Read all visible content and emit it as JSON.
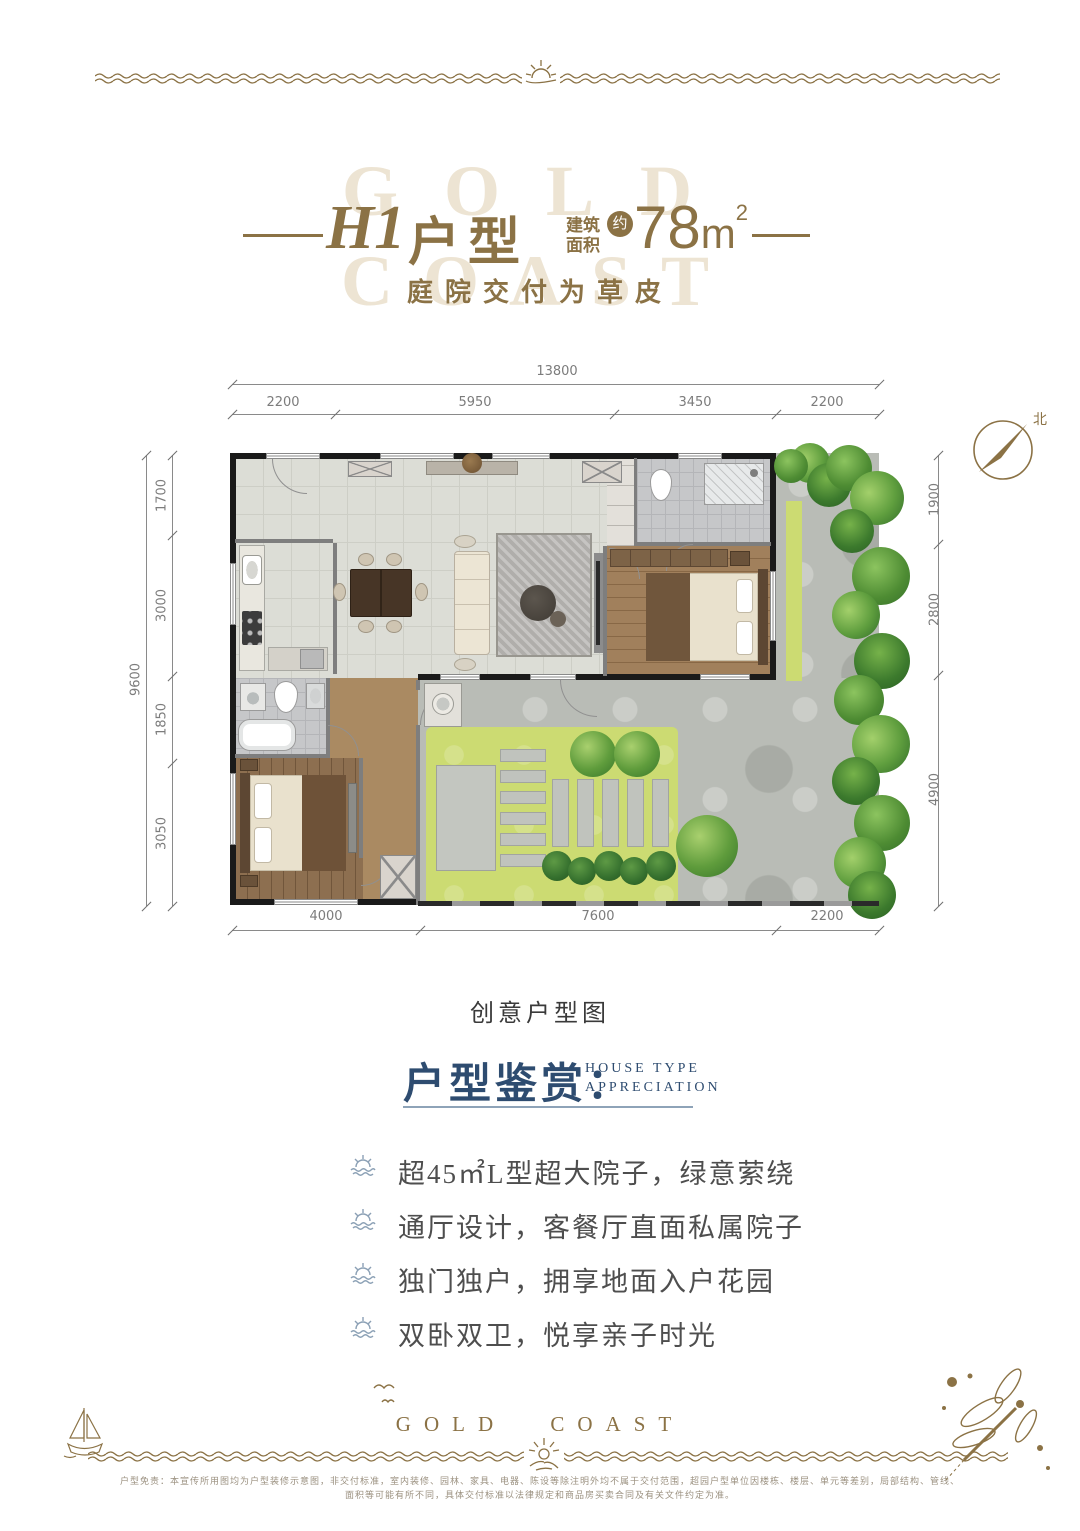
{
  "header": {
    "watermark": [
      "GOLD",
      "COAST"
    ],
    "title_code": "H1",
    "title_type": "户型",
    "area_label_1": "建筑",
    "area_label_2": "面积",
    "area_approx": "约",
    "area_value": "78",
    "area_unit": "m",
    "area_exp": "2",
    "subtitle": "庭院交付为草皮"
  },
  "floorplan": {
    "compass_label": "北",
    "caption": "创意户型图",
    "dims": {
      "top_total": "13800",
      "top": [
        "2200",
        "5950",
        "3450",
        "2200"
      ],
      "left_total": "9600",
      "left": [
        "1700",
        "3000",
        "1850",
        "3050"
      ],
      "right": [
        "1900",
        "2800",
        "4900"
      ],
      "bottom": [
        "4000",
        "7600",
        "2200"
      ]
    }
  },
  "appreciation": {
    "title": "户型鉴赏：",
    "en_line1": "HOUSE TYPE",
    "en_line2": "APPRECIATION",
    "bullets": [
      "超45㎡L型超大院子，绿意萦绕",
      "通厅设计，客餐厅直面私属院子",
      "独门独户，拥享地面入户花园",
      "双卧双卫，悦享亲子时光"
    ]
  },
  "footer": {
    "brand": "GOLD COAST",
    "disclaimer_line1": "户型免责：本宣传所用图均为户型装修示意图，非交付标准，室内装修、园林、家具、电器、陈设等除注明外均不属于交付范围，超园户型单位因楼栋、楼层、单元等差别，局部结构、管线、",
    "disclaimer_line2": "面积等可能有所不同，具体交付标准以法律规定和商品房买卖合同及有关文件约定为准。"
  },
  "colors": {
    "gold": "#8b7245",
    "navy": "#2e4c70",
    "watermark": "#ede4d3",
    "lawn_green": "#ccdb72",
    "hedge_green": "#4e8c33",
    "wall_black": "#1a1a1a"
  }
}
